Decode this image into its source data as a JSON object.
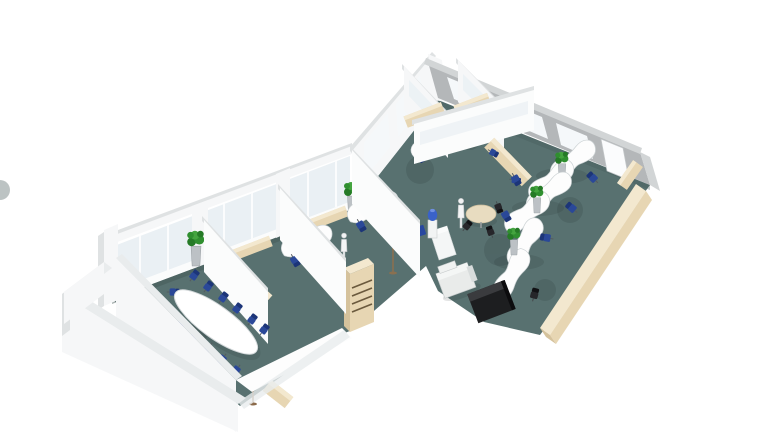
{
  "scene": {
    "description": "3D isometric cutaway rendering of an office floor plan on a white background, viewed from the south-east",
    "style": "architectural visualization render",
    "floor_covering": "teal carpet",
    "walls": "white with glazed window bands"
  },
  "colors": {
    "background": "#ffffff",
    "carpet": "#587170",
    "wall_white": "#f6f7f8",
    "wall_shaded": "#b4b7b9",
    "glass": "#eaf0f4",
    "cabinet_beige": "#e7d6b3",
    "desk_white": "#fdfdfd",
    "chair_blue": "#2a4898",
    "chair_black": "#26262a",
    "plant_green": "#2f8f2f",
    "plant_pot": "#bcc1c5",
    "water_bottle": "#3a62c8",
    "copier_white": "#e9ebea",
    "furniture_black": "#1d1e20",
    "round_table": "#e8dcc0"
  },
  "rooms": [
    {
      "id": "conference-room",
      "position": "bottom-left",
      "furniture": [
        "oval conference table",
        "13 blue chairs",
        "beige sideboard",
        "tall potted plant",
        "floor lamp",
        "small beige cabinet"
      ]
    },
    {
      "id": "private-office-1",
      "position": "center-left",
      "furniture": [
        "kidney desk",
        "2 blue task chairs",
        "window sideboard",
        "tall potted plant"
      ]
    },
    {
      "id": "private-office-2",
      "position": "center",
      "furniture": [
        "kidney desk",
        "2 blue task chairs",
        "window sideboard",
        "tall potted plant",
        "slatted beige cabinet"
      ]
    },
    {
      "id": "glass-offices",
      "position": "top-center",
      "furniture": [
        "2 kidney desks",
        "blue task chairs",
        "beige cabinet rows",
        "glass partition walls"
      ]
    },
    {
      "id": "corridor",
      "position": "center",
      "furniture": [
        "water cooler",
        "blue recycling bin",
        "white cabinet",
        "coat rack",
        "2 white mannequin figures"
      ]
    },
    {
      "id": "open-plan-area",
      "position": "right",
      "furniture": [
        "3 double kidney workstations",
        "single kidney desk",
        "round meeting table with 3 chairs",
        "photocopier",
        "black media cabinet",
        "beige sideboard strip along window edge",
        "entrance door",
        "potted plants"
      ]
    }
  ],
  "counts": {
    "kidney_desks": 9,
    "conference_chairs": 13,
    "task_chairs_blue": 18,
    "potted_plants": 9,
    "mannequins": 2,
    "doors": 1
  }
}
